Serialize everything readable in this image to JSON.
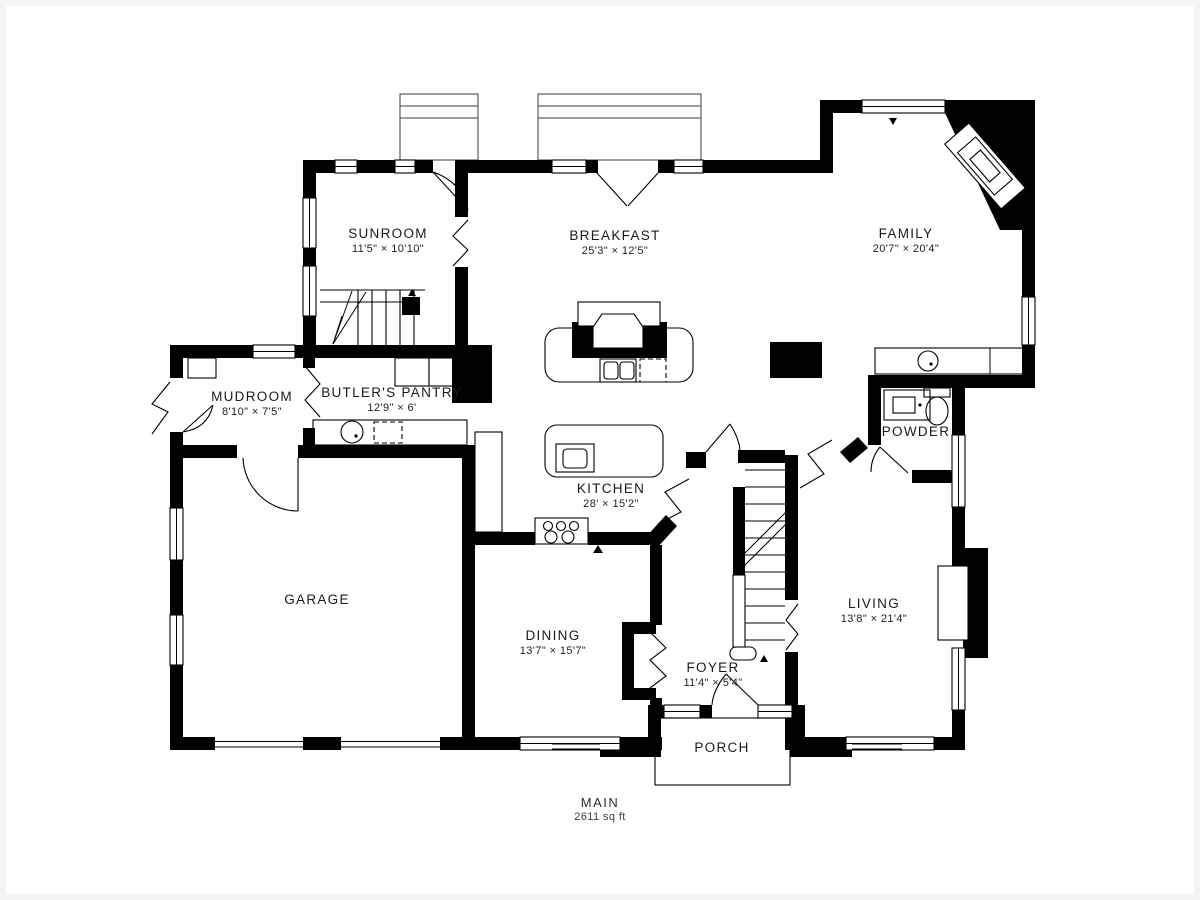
{
  "plan": {
    "floor": {
      "label": "MAIN",
      "area": "2611 sq ft"
    },
    "rooms": [
      {
        "id": "sunroom",
        "name": "SUNROOM",
        "dims": "11'5\" × 10'10\""
      },
      {
        "id": "breakfast",
        "name": "BREAKFAST",
        "dims": "25'3\" × 12'5\""
      },
      {
        "id": "family",
        "name": "FAMILY",
        "dims": "20'7\" × 20'4\""
      },
      {
        "id": "mudroom",
        "name": "MUDROOM",
        "dims": "8'10\" × 7'5\""
      },
      {
        "id": "butlers-pantry",
        "name": "BUTLER'S PANTRY",
        "dims": "12'9\" × 6'"
      },
      {
        "id": "kitchen",
        "name": "KITCHEN",
        "dims": "28' × 15'2\""
      },
      {
        "id": "powder",
        "name": "POWDER",
        "dims": ""
      },
      {
        "id": "garage",
        "name": "GARAGE",
        "dims": ""
      },
      {
        "id": "dining",
        "name": "DINING",
        "dims": "13'7\" × 15'7\""
      },
      {
        "id": "foyer",
        "name": "FOYER",
        "dims": "11'4\" × 5'4\""
      },
      {
        "id": "living",
        "name": "LIVING",
        "dims": "13'8\" × 21'4\""
      },
      {
        "id": "porch",
        "name": "PORCH",
        "dims": ""
      }
    ],
    "colors": {
      "wall": "#000000",
      "background": "#ffffff",
      "text": "#1b1b1b"
    }
  }
}
